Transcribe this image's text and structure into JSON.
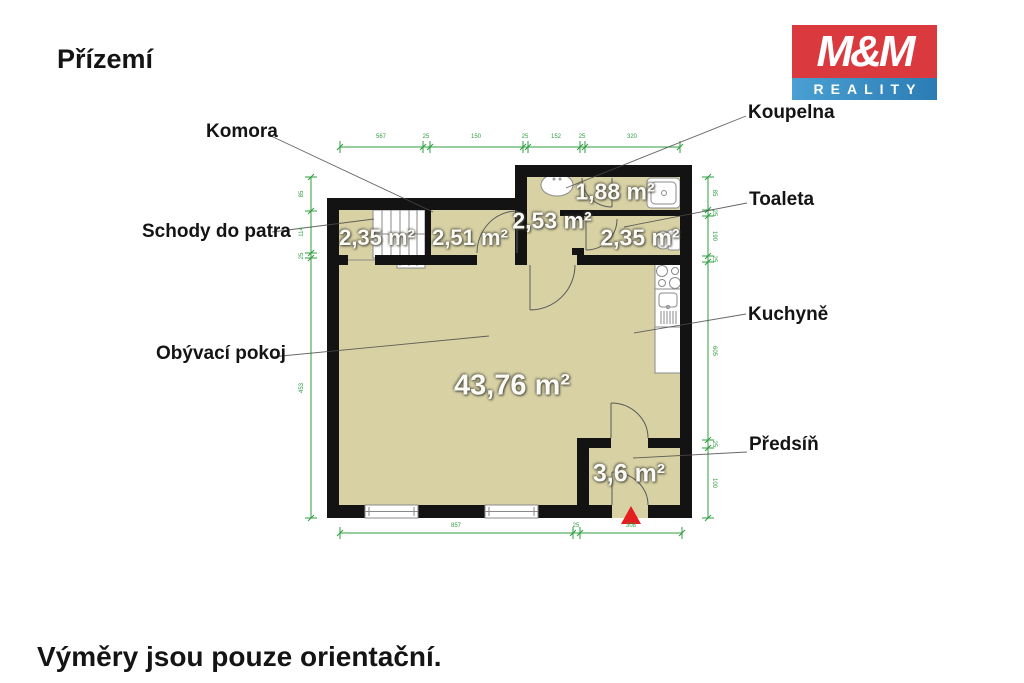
{
  "title": "Přízemí",
  "footer": "Výměry jsou pouze orientační.",
  "logo": {
    "line1": "M&M",
    "line2": "REALITY"
  },
  "room_labels": {
    "komora": "Komora",
    "schody": "Schody do patra",
    "koupelna": "Koupelna",
    "toaleta": "Toaleta",
    "kuchyne": "Kuchyně",
    "obyvaci": "Obývací pokoj",
    "predsin": "Předsíň"
  },
  "areas": {
    "schody": "2,35 m²",
    "komora": "2,51 m²",
    "chodba": "2,53 m²",
    "koupelna": "1,88 m²",
    "toaleta": "2,35 m²",
    "obyvaci": "43,76 m²",
    "predsin": "3,6 m²"
  },
  "dimensions": {
    "top": [
      "567",
      "25",
      "150",
      "25",
      "152",
      "25",
      "320"
    ],
    "left": [
      "85",
      "114",
      "25",
      "453"
    ],
    "right": [
      "85",
      "25",
      "190",
      "25",
      "605",
      "25",
      "100"
    ],
    "bottom": [
      "857",
      "25",
      "308"
    ]
  },
  "colors": {
    "floor": "#d7d1a4",
    "wall": "#131313",
    "dim": "#2f9e3f",
    "arrow": "#e41e1e",
    "logo_red": "#da393e",
    "logo_blue_left": "#4aa0d2",
    "logo_blue_right": "#2b7cb4"
  }
}
